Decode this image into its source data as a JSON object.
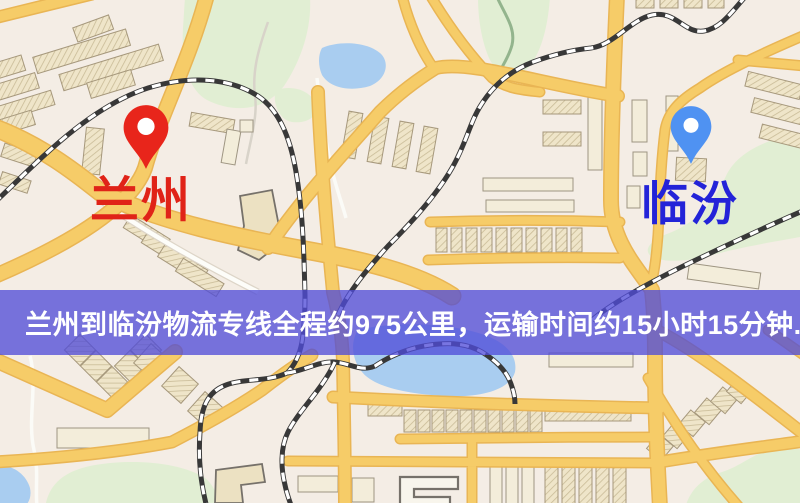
{
  "map": {
    "origin": {
      "name": "兰州"
    },
    "destination": {
      "name": "临汾"
    }
  },
  "banner": {
    "text": "兰州到临汾物流专线全程约975公里，运输时间约15小时15分钟."
  },
  "route": {
    "from": "兰州",
    "to": "临汾",
    "distance": "约975公里",
    "duration": "约15小时15分钟"
  },
  "icons": {
    "origin_pin": "red-map-marker",
    "destination_pin": "blue-map-marker"
  },
  "colors": {
    "map_bg": "#f4ede5",
    "road_fill": "#f6cc68",
    "road_casing": "#e9b554",
    "road_white": "#fdfdf9",
    "road_white_casing": "#ddd5c8",
    "rail_dark": "#383838",
    "rail_light": "#ffffff",
    "water": "#a9cdf0",
    "park_green": "#e1eed3",
    "building_fill": "#efe5c9",
    "building_hatch": "#c9bb97",
    "building_outline": "#a6987c",
    "building_dark_outline": "#76716a",
    "pin_red": "#e8251b",
    "pin_blue": "#4f92f2",
    "pin_hole": "#ffffff",
    "label_red": "#e02318",
    "label_blue": "#2323d8",
    "banner_bg": "#504cd8c4",
    "banner_text": "#ffffff"
  }
}
